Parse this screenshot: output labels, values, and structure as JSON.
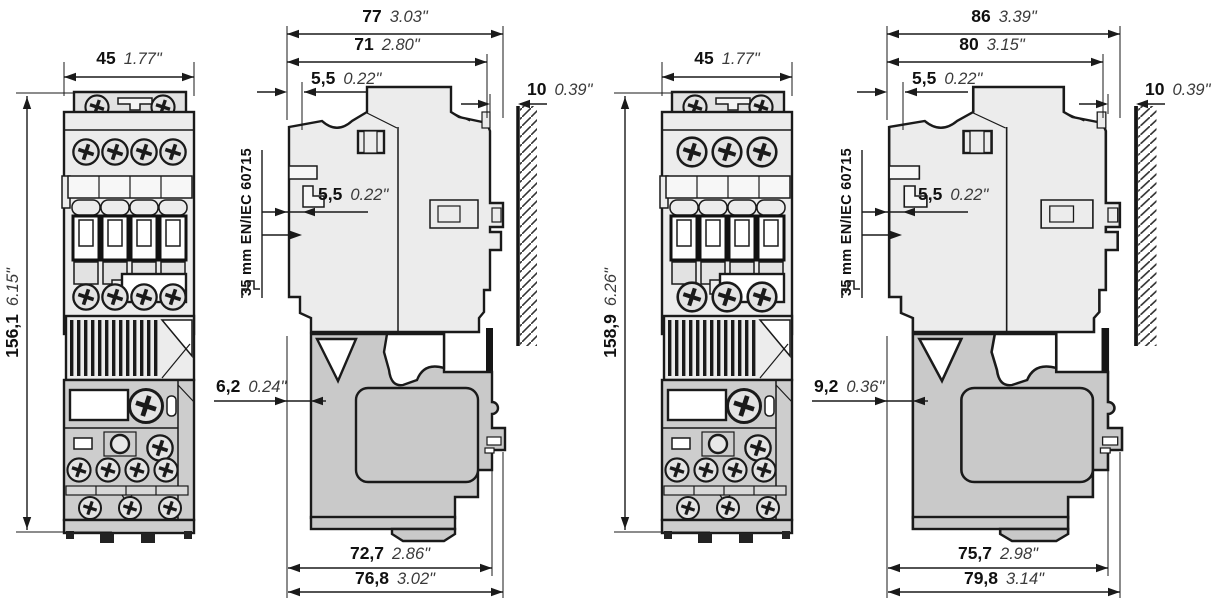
{
  "figure": {
    "type": "technical-dimension-drawing",
    "subject": "Contactor with overload relay - front and side views with overall dimensions",
    "views_per_group": [
      "front view",
      "side view on wall with DIN rail"
    ]
  },
  "colors": {
    "line": "#1a1a1a",
    "contactor_fill": "#ececec",
    "relay_fill": "#c9c9c9",
    "background": "#ffffff"
  },
  "groups": [
    {
      "front": {
        "width": {
          "mm": "45",
          "inch": "1.77\""
        },
        "height": {
          "mm": "156,1",
          "inch": "6.15\""
        }
      },
      "side": {
        "total_depth": {
          "mm": "77",
          "inch": "3.03\""
        },
        "body_depth": {
          "mm": "71",
          "inch": "2.80\""
        },
        "top_offset": {
          "mm": "5,5",
          "inch": "0.22\""
        },
        "wall_clearance": {
          "mm": "10",
          "inch": "0.39\""
        },
        "rail_offset": {
          "mm": "5,5",
          "inch": "0.22\""
        },
        "din_rail_label": "35 mm EN/IEC 60715",
        "relay_offset": {
          "mm": "6,2",
          "inch": "0.24\""
        },
        "relay_depth": {
          "mm": "72,7",
          "inch": "2.86\""
        },
        "relay_total_depth": {
          "mm": "76,8",
          "inch": "3.02\""
        }
      }
    },
    {
      "front": {
        "width": {
          "mm": "45",
          "inch": "1.77\""
        },
        "height": {
          "mm": "158,9",
          "inch": "6.26\""
        }
      },
      "side": {
        "total_depth": {
          "mm": "86",
          "inch": "3.39\""
        },
        "body_depth": {
          "mm": "80",
          "inch": "3.15\""
        },
        "top_offset": {
          "mm": "5,5",
          "inch": "0.22\""
        },
        "wall_clearance": {
          "mm": "10",
          "inch": "0.39\""
        },
        "rail_offset": {
          "mm": "5,5",
          "inch": "0.22\""
        },
        "din_rail_label": "35 mm EN/IEC 60715",
        "relay_offset": {
          "mm": "9,2",
          "inch": "0.36\""
        },
        "relay_depth": {
          "mm": "75,7",
          "inch": "2.98\""
        },
        "relay_total_depth": {
          "mm": "79,8",
          "inch": "3.14\""
        }
      }
    }
  ]
}
